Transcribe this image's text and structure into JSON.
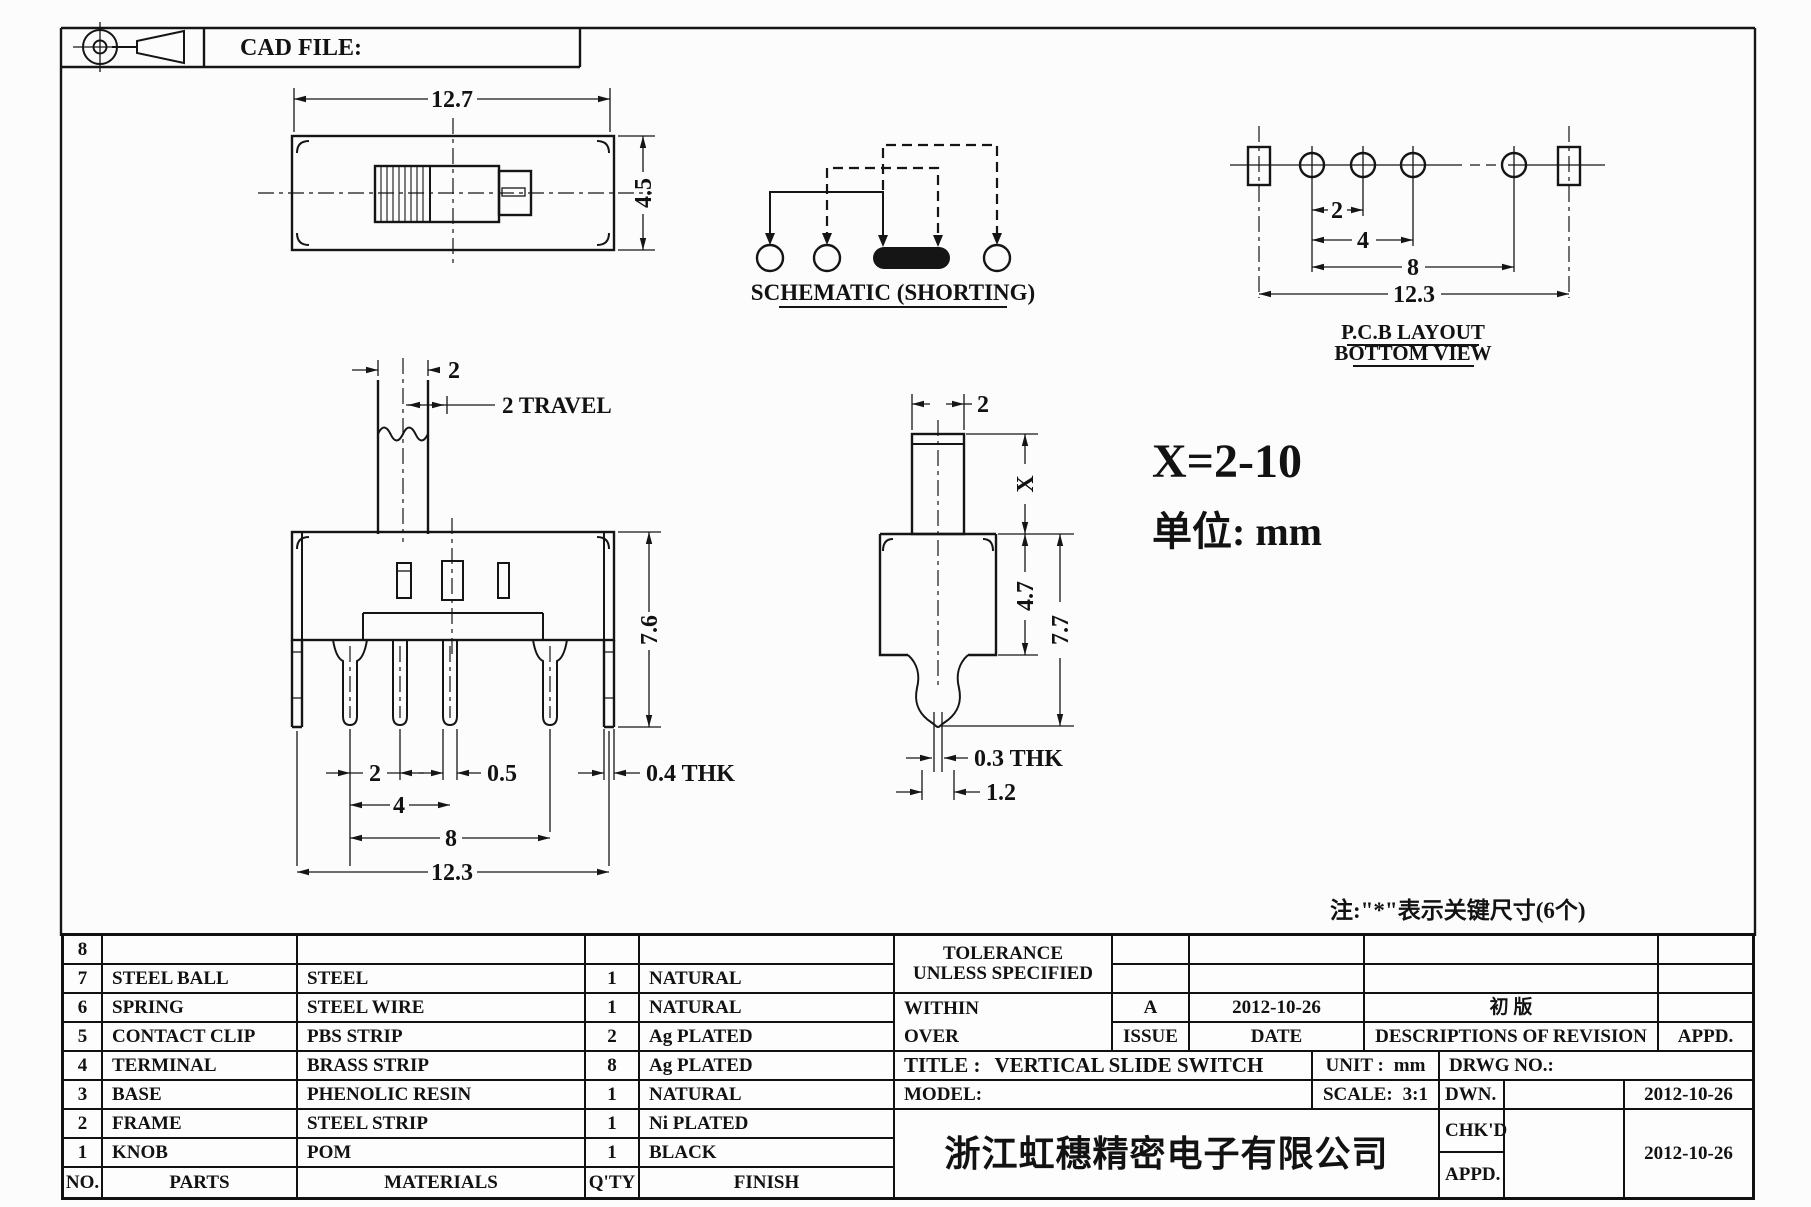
{
  "header": {
    "cad_file": "CAD FILE:"
  },
  "drawing": {
    "top_view": {
      "dim_width": "12.7",
      "dim_height": "4.5"
    },
    "schematic": {
      "title": "SCHEMATIC (SHORTING)"
    },
    "pcb_layout": {
      "dim_pitch1": "2",
      "dim_pitch2": "4",
      "dim_pitch3": "8",
      "dim_overall": "12.3",
      "title1": "P.C.B LAYOUT",
      "title2": "BOTTOM VIEW"
    },
    "front_view": {
      "dim_knob": "2",
      "dim_travel": "2 TRAVEL",
      "dim_height": "7.6",
      "dim_pitch1": "2",
      "dim_pin_w": "0.5",
      "dim_pitch2": "4",
      "dim_pitch3": "8",
      "dim_overall": "12.3",
      "dim_thk": "0.4 THK"
    },
    "side_view": {
      "dim_stem_w": "2",
      "dim_x": "X",
      "dim_body_h": "4.7",
      "dim_total_h": "7.7",
      "dim_thk": "0.3 THK",
      "dim_tip_w": "1.2"
    },
    "notes": {
      "x_range": "X=2-10",
      "unit": "单位: mm",
      "key_note": "注:\"*\"表示关键尺寸(6个)"
    }
  },
  "parts_table": {
    "headers": {
      "no": "NO.",
      "parts": "PARTS",
      "materials": "MATERIALS",
      "qty": "Q'TY",
      "finish": "FINISH"
    },
    "rows": [
      {
        "no": "8",
        "parts": "",
        "materials": "",
        "qty": "",
        "finish": ""
      },
      {
        "no": "7",
        "parts": "STEEL BALL",
        "materials": "STEEL",
        "qty": "1",
        "finish": "NATURAL"
      },
      {
        "no": "6",
        "parts": "SPRING",
        "materials": "STEEL WIRE",
        "qty": "1",
        "finish": "NATURAL"
      },
      {
        "no": "5",
        "parts": "CONTACT CLIP",
        "materials": "PBS STRIP",
        "qty": "2",
        "finish": "Ag PLATED"
      },
      {
        "no": "4",
        "parts": "TERMINAL",
        "materials": "BRASS STRIP",
        "qty": "8",
        "finish": "Ag PLATED"
      },
      {
        "no": "3",
        "parts": "BASE",
        "materials": "PHENOLIC RESIN",
        "qty": "1",
        "finish": "NATURAL"
      },
      {
        "no": "2",
        "parts": "FRAME",
        "materials": "STEEL STRIP",
        "qty": "1",
        "finish": "Ni PLATED"
      },
      {
        "no": "1",
        "parts": "KNOB",
        "materials": "POM",
        "qty": "1",
        "finish": "BLACK"
      }
    ]
  },
  "revision_block": {
    "tolerance1": "TOLERANCE",
    "tolerance2": "UNLESS  SPECIFIED",
    "within": "WITHIN",
    "over": "OVER",
    "issue_value": "A",
    "issue_date": "2012-10-26",
    "issue_label": "ISSUE",
    "date_label": "DATE",
    "revision_desc": "初  版",
    "desc_label": "DESCRIPTIONS OF REVISION",
    "appd_label": "APPD."
  },
  "title_block": {
    "title_label": "TITLE :",
    "title_value": "VERTICAL SLIDE SWITCH",
    "unit_label": "UNIT :",
    "unit_value": "mm",
    "drwg_label": "DRWG NO.:",
    "model_label": "MODEL:",
    "scale_label": "SCALE:",
    "scale_value": "3:1",
    "dwn_label": "DWN.",
    "dwn_date": "2012-10-26",
    "chkd_label": "CHK'D",
    "appd_label": "APPD.",
    "chkd_date": "2012-10-26",
    "company": "浙江虹穗精密电子有限公司"
  }
}
